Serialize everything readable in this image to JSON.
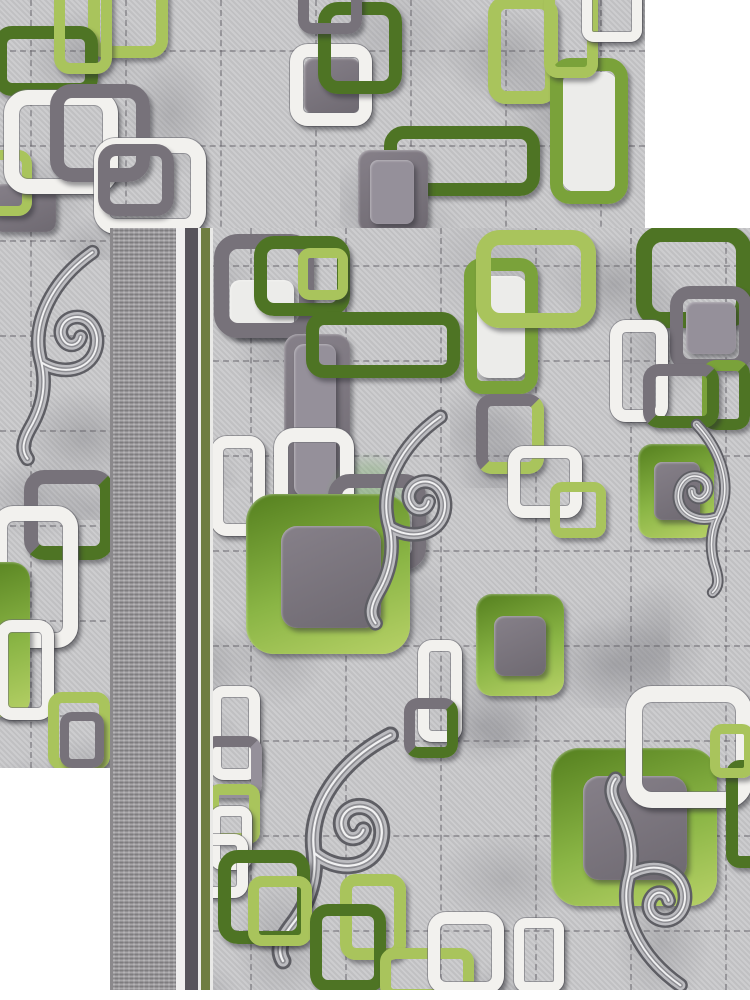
{
  "scene": {
    "kind": "photo-of-two-overlapping-carpet-samples",
    "background": "#ffffff",
    "pattern_style": "interlocked rounded-square chain links with damask scroll flourishes on marbled grey field with stitched grid"
  },
  "palette": {
    "white": "#f2f1ee",
    "white_fill": "#ececea",
    "dark_gray": "#77727a",
    "mid_gray": "#95909a",
    "dark_green": "#4e7424",
    "green": "#7aa23a",
    "lime": "#a9c45c",
    "field_base": "#cacacc",
    "green_fill": "linear-gradient(160deg,#55801f 0%,#8ab545 55%,#b7d167 100%)",
    "gray_fill": "linear-gradient(155deg,#868089 0%,#6e6971 100%)",
    "border_olive": "#6f7d41",
    "border_dark": "#57545b",
    "watermark_green": "rgba(113,170,96,0.55)"
  },
  "panels": [
    {
      "id": "back",
      "x": 0,
      "y": 0,
      "w": 645,
      "h": 768,
      "fx": 0,
      "grid": {
        "v": [
          30,
          125,
          220,
          315,
          410,
          505,
          600
        ],
        "h": [
          50,
          145,
          240,
          335,
          430,
          525,
          620,
          715
        ]
      }
    },
    {
      "id": "front",
      "x": 110,
      "y": 228,
      "w": 640,
      "h": 762,
      "fx": 103,
      "grid": {
        "v": [
          37,
          132,
          227,
          322,
          417,
          512
        ],
        "h": [
          37,
          132,
          227,
          322,
          417,
          512,
          607,
          702
        ]
      },
      "stripes": [
        {
          "x": 0,
          "w": 3,
          "c": "#8b898c"
        },
        {
          "x": 3,
          "w": 63,
          "texture": true
        },
        {
          "x": 66,
          "w": 9,
          "c": "#f0efef"
        },
        {
          "x": 75,
          "w": 13,
          "c": "#57545b"
        },
        {
          "x": 88,
          "w": 3,
          "c": "#ededec"
        },
        {
          "x": 91,
          "w": 9,
          "c": "#6f7d41"
        },
        {
          "x": 100,
          "w": 3,
          "c": "#e9e9e7"
        }
      ]
    }
  ],
  "motifs": [
    {
      "p": "back",
      "t": "ring",
      "x": 88,
      "y": -20,
      "w": 80,
      "h": 78,
      "r": 18,
      "b": 12,
      "c": "lime"
    },
    {
      "p": "back",
      "t": "ring",
      "x": -6,
      "y": 26,
      "w": 104,
      "h": 70,
      "r": 18,
      "b": 13,
      "c": "dark_green"
    },
    {
      "p": "back",
      "t": "ring",
      "x": 54,
      "y": -24,
      "w": 58,
      "h": 98,
      "r": 16,
      "b": 11,
      "c": "lime"
    },
    {
      "p": "back",
      "t": "fill",
      "x": -8,
      "y": 184,
      "w": 64,
      "h": 48,
      "r": 10,
      "c": "gray_fill"
    },
    {
      "p": "back",
      "t": "ring",
      "x": -14,
      "y": 150,
      "w": 46,
      "h": 66,
      "r": 14,
      "b": 10,
      "c": "lime"
    },
    {
      "p": "back",
      "t": "ring",
      "x": 4,
      "y": 90,
      "w": 114,
      "h": 104,
      "r": 24,
      "b": 15,
      "c": "white"
    },
    {
      "p": "back",
      "t": "ring",
      "x": 50,
      "y": 84,
      "w": 100,
      "h": 98,
      "r": 22,
      "b": 14,
      "c": "dark_gray"
    },
    {
      "p": "back",
      "t": "ring",
      "x": 94,
      "y": 138,
      "w": 112,
      "h": 96,
      "r": 22,
      "b": 15,
      "c": "white"
    },
    {
      "p": "back",
      "t": "ring",
      "x": 98,
      "y": 144,
      "w": 76,
      "h": 72,
      "r": 18,
      "b": 12,
      "c": "dark_gray"
    },
    {
      "p": "back",
      "t": "fill",
      "x": 304,
      "y": 58,
      "w": 56,
      "h": 56,
      "r": 10,
      "c": "gray_fill"
    },
    {
      "p": "back",
      "t": "ring",
      "x": 290,
      "y": 44,
      "w": 82,
      "h": 82,
      "r": 18,
      "b": 13,
      "c": "white"
    },
    {
      "p": "back",
      "t": "ring",
      "x": 318,
      "y": 2,
      "w": 84,
      "h": 92,
      "r": 20,
      "b": 13,
      "c": "dark_green"
    },
    {
      "p": "back",
      "t": "ring",
      "x": 298,
      "y": -18,
      "w": 64,
      "h": 52,
      "r": 14,
      "b": 11,
      "c": "dark_gray"
    },
    {
      "p": "back",
      "t": "ring",
      "x": 384,
      "y": 126,
      "w": 156,
      "h": 70,
      "r": 20,
      "b": 13,
      "c": "dark_green"
    },
    {
      "p": "back",
      "t": "fill",
      "x": 358,
      "y": 150,
      "w": 70,
      "h": 82,
      "r": 12,
      "c": "gray_fill"
    },
    {
      "p": "back",
      "t": "fill",
      "x": 370,
      "y": 160,
      "w": 44,
      "h": 64,
      "r": 8,
      "c": "mid_gray"
    },
    {
      "p": "back",
      "t": "ring",
      "x": 488,
      "y": -4,
      "w": 70,
      "h": 108,
      "r": 18,
      "b": 13,
      "c": "lime"
    },
    {
      "p": "back",
      "t": "fill",
      "x": 562,
      "y": 72,
      "w": 56,
      "h": 120,
      "r": 14,
      "c": "white_fill"
    },
    {
      "p": "back",
      "t": "ring",
      "x": 550,
      "y": 58,
      "w": 78,
      "h": 146,
      "r": 20,
      "b": 13,
      "c": "green"
    },
    {
      "p": "back",
      "t": "ring",
      "x": 544,
      "y": -14,
      "w": 54,
      "h": 92,
      "r": 14,
      "b": 11,
      "c": "lime"
    },
    {
      "p": "back",
      "t": "ring",
      "x": 582,
      "y": -16,
      "w": 60,
      "h": 58,
      "r": 12,
      "b": 10,
      "c": "white"
    },
    {
      "p": "back",
      "t": "flourish",
      "x": 2,
      "y": 232,
      "w": 118,
      "h": 245,
      "rot": 0,
      "flip": false
    },
    {
      "p": "back",
      "t": "ring",
      "x": 24,
      "y": 470,
      "w": 90,
      "h": 90,
      "r": 20,
      "b": 14,
      "c": "dark_gray",
      "c2": "dark_green"
    },
    {
      "p": "back",
      "t": "ring",
      "x": -8,
      "y": 506,
      "w": 86,
      "h": 142,
      "r": 22,
      "b": 15,
      "c": "white"
    },
    {
      "p": "back",
      "t": "fill",
      "x": -34,
      "y": 562,
      "w": 64,
      "h": 155,
      "r": 18,
      "c": "green_fill"
    },
    {
      "p": "back",
      "t": "ring",
      "x": -4,
      "y": 620,
      "w": 58,
      "h": 100,
      "r": 16,
      "b": 12,
      "c": "white"
    },
    {
      "p": "back",
      "t": "ring",
      "x": 48,
      "y": 692,
      "w": 62,
      "h": 78,
      "r": 14,
      "b": 11,
      "c": "lime"
    },
    {
      "p": "back",
      "t": "ring",
      "x": 60,
      "y": 712,
      "w": 44,
      "h": 56,
      "r": 12,
      "b": 9,
      "c": "dark_gray"
    },
    {
      "p": "front",
      "t": "fill",
      "x": 230,
      "y": 280,
      "w": 64,
      "h": 58,
      "r": 10,
      "c": "white_fill"
    },
    {
      "p": "front",
      "t": "ring",
      "x": 214,
      "y": 234,
      "w": 100,
      "h": 104,
      "r": 24,
      "b": 15,
      "c": "dark_gray"
    },
    {
      "p": "front",
      "t": "ring",
      "x": 254,
      "y": 236,
      "w": 96,
      "h": 80,
      "r": 20,
      "b": 13,
      "c": "dark_green"
    },
    {
      "p": "front",
      "t": "ring",
      "x": 298,
      "y": 248,
      "w": 50,
      "h": 52,
      "r": 12,
      "b": 10,
      "c": "lime"
    },
    {
      "p": "front",
      "t": "fill",
      "x": 284,
      "y": 334,
      "w": 66,
      "h": 180,
      "r": 14,
      "c": "gray_fill"
    },
    {
      "p": "front",
      "t": "fill",
      "x": 294,
      "y": 344,
      "w": 42,
      "h": 152,
      "r": 10,
      "c": "mid_gray"
    },
    {
      "p": "front",
      "t": "ring",
      "x": 306,
      "y": 312,
      "w": 154,
      "h": 66,
      "r": 18,
      "b": 13,
      "c": "dark_green"
    },
    {
      "p": "front",
      "t": "fill",
      "x": 477,
      "y": 276,
      "w": 50,
      "h": 102,
      "r": 12,
      "c": "white_fill"
    },
    {
      "p": "front",
      "t": "ring",
      "x": 464,
      "y": 258,
      "w": 74,
      "h": 136,
      "r": 18,
      "b": 13,
      "c": "green"
    },
    {
      "p": "front",
      "t": "ring",
      "x": 476,
      "y": 230,
      "w": 120,
      "h": 98,
      "r": 24,
      "b": 15,
      "c": "lime"
    },
    {
      "p": "front",
      "t": "ring",
      "x": 636,
      "y": 226,
      "w": 116,
      "h": 102,
      "r": 26,
      "b": 16,
      "c": "dark_green"
    },
    {
      "p": "front",
      "t": "fill",
      "x": 686,
      "y": 302,
      "w": 50,
      "h": 52,
      "r": 8,
      "c": "mid_gray"
    },
    {
      "p": "front",
      "t": "ring",
      "x": 670,
      "y": 286,
      "w": 82,
      "h": 86,
      "r": 20,
      "b": 13,
      "c": "dark_gray"
    },
    {
      "p": "front",
      "t": "ring",
      "x": 610,
      "y": 320,
      "w": 58,
      "h": 102,
      "r": 16,
      "b": 12,
      "c": "white"
    },
    {
      "p": "front",
      "t": "ring",
      "x": 702,
      "y": 360,
      "w": 48,
      "h": 70,
      "r": 14,
      "b": 11,
      "c": "green",
      "c2": "dark_green"
    },
    {
      "p": "front",
      "t": "ring",
      "x": 643,
      "y": 364,
      "w": 76,
      "h": 64,
      "r": 16,
      "b": 12,
      "c": "dark_gray",
      "c2": "dark_green"
    },
    {
      "p": "front",
      "t": "fill",
      "x": 638,
      "y": 444,
      "w": 76,
      "h": 94,
      "r": 14,
      "c": "green_fill"
    },
    {
      "p": "front",
      "t": "fill",
      "x": 654,
      "y": 462,
      "w": 46,
      "h": 58,
      "r": 8,
      "c": "gray_fill"
    },
    {
      "p": "front",
      "t": "watermark",
      "x": 310,
      "y": 436,
      "w": 118,
      "h": 138
    },
    {
      "p": "front",
      "t": "ring",
      "x": 274,
      "y": 428,
      "w": 80,
      "h": 104,
      "r": 20,
      "b": 14,
      "c": "white"
    },
    {
      "p": "front",
      "t": "ring",
      "x": 211,
      "y": 436,
      "w": 54,
      "h": 100,
      "r": 16,
      "b": 12,
      "c": "white"
    },
    {
      "p": "front",
      "t": "ring",
      "x": 328,
      "y": 474,
      "w": 98,
      "h": 96,
      "r": 22,
      "b": 14,
      "c": "dark_gray"
    },
    {
      "p": "front",
      "t": "fill",
      "x": 246,
      "y": 494,
      "w": 164,
      "h": 160,
      "r": 28,
      "c": "green_fill"
    },
    {
      "p": "front",
      "t": "fill",
      "x": 281,
      "y": 526,
      "w": 100,
      "h": 102,
      "r": 16,
      "c": "gray_fill"
    },
    {
      "p": "front",
      "t": "flourish",
      "x": 350,
      "y": 404,
      "w": 118,
      "h": 230,
      "rot": 0,
      "flip": false
    },
    {
      "p": "front",
      "t": "ring",
      "x": 476,
      "y": 394,
      "w": 68,
      "h": 80,
      "r": 16,
      "b": 12,
      "c": "dark_gray",
      "c2": "lime"
    },
    {
      "p": "front",
      "t": "ring",
      "x": 508,
      "y": 446,
      "w": 74,
      "h": 72,
      "r": 16,
      "b": 12,
      "c": "white"
    },
    {
      "p": "front",
      "t": "ring",
      "x": 550,
      "y": 482,
      "w": 56,
      "h": 56,
      "r": 12,
      "b": 10,
      "c": "lime"
    },
    {
      "p": "front",
      "t": "fill",
      "x": 476,
      "y": 594,
      "w": 88,
      "h": 102,
      "r": 16,
      "c": "green_fill"
    },
    {
      "p": "front",
      "t": "fill",
      "x": 494,
      "y": 616,
      "w": 52,
      "h": 60,
      "r": 10,
      "c": "gray_fill"
    },
    {
      "p": "front",
      "t": "flourish",
      "x": 658,
      "y": 420,
      "w": 92,
      "h": 175,
      "rot": 12,
      "flip": true
    },
    {
      "p": "front",
      "t": "ring",
      "x": 418,
      "y": 640,
      "w": 44,
      "h": 102,
      "r": 14,
      "b": 11,
      "c": "white"
    },
    {
      "p": "front",
      "t": "ring",
      "x": 404,
      "y": 698,
      "w": 54,
      "h": 60,
      "r": 14,
      "b": 11,
      "c": "dark_gray",
      "c2": "dark_green"
    },
    {
      "p": "front",
      "t": "ring",
      "x": 210,
      "y": 686,
      "w": 50,
      "h": 94,
      "r": 14,
      "b": 11,
      "c": "white"
    },
    {
      "p": "front",
      "t": "ring",
      "x": 202,
      "y": 736,
      "w": 60,
      "h": 62,
      "r": 14,
      "b": 11,
      "c": "dark_gray",
      "c2": "mid_gray"
    },
    {
      "p": "front",
      "t": "ring",
      "x": 208,
      "y": 784,
      "w": 52,
      "h": 60,
      "r": 12,
      "b": 11,
      "c": "lime"
    },
    {
      "p": "front",
      "t": "ring",
      "x": 210,
      "y": 806,
      "w": 42,
      "h": 64,
      "r": 12,
      "b": 10,
      "c": "white"
    },
    {
      "p": "front",
      "t": "fill",
      "x": 551,
      "y": 748,
      "w": 166,
      "h": 158,
      "r": 28,
      "c": "green_fill"
    },
    {
      "p": "front",
      "t": "fill",
      "x": 583,
      "y": 776,
      "w": 104,
      "h": 104,
      "r": 16,
      "c": "gray_fill"
    },
    {
      "p": "front",
      "t": "ring",
      "x": 626,
      "y": 686,
      "w": 126,
      "h": 122,
      "r": 26,
      "b": 16,
      "c": "white"
    },
    {
      "p": "front",
      "t": "flourish",
      "x": 590,
      "y": 772,
      "w": 118,
      "h": 222,
      "rot": 180,
      "flip": true
    },
    {
      "p": "front",
      "t": "flourish",
      "x": 258,
      "y": 722,
      "w": 160,
      "h": 250,
      "rot": 8,
      "flip": false
    },
    {
      "p": "front",
      "t": "ring",
      "x": 194,
      "y": 834,
      "w": 54,
      "h": 64,
      "r": 14,
      "b": 11,
      "c": "white"
    },
    {
      "p": "front",
      "t": "ring",
      "x": 218,
      "y": 850,
      "w": 92,
      "h": 94,
      "r": 20,
      "b": 13,
      "c": "dark_green"
    },
    {
      "p": "front",
      "t": "ring",
      "x": 248,
      "y": 876,
      "w": 64,
      "h": 70,
      "r": 14,
      "b": 11,
      "c": "lime"
    },
    {
      "p": "front",
      "t": "ring",
      "x": 340,
      "y": 874,
      "w": 66,
      "h": 86,
      "r": 16,
      "b": 12,
      "c": "lime"
    },
    {
      "p": "front",
      "t": "ring",
      "x": 310,
      "y": 904,
      "w": 76,
      "h": 88,
      "r": 18,
      "b": 12,
      "c": "dark_green"
    },
    {
      "p": "front",
      "t": "ring",
      "x": 380,
      "y": 948,
      "w": 94,
      "h": 52,
      "r": 14,
      "b": 11,
      "c": "lime"
    },
    {
      "p": "front",
      "t": "ring",
      "x": 428,
      "y": 912,
      "w": 76,
      "h": 82,
      "r": 18,
      "b": 12,
      "c": "white"
    },
    {
      "p": "front",
      "t": "ring",
      "x": 514,
      "y": 918,
      "w": 50,
      "h": 74,
      "r": 12,
      "b": 10,
      "c": "white"
    },
    {
      "p": "front",
      "t": "ring",
      "x": 726,
      "y": 760,
      "w": 42,
      "h": 108,
      "r": 14,
      "b": 12,
      "c": "dark_green"
    },
    {
      "p": "front",
      "t": "ring",
      "x": 710,
      "y": 724,
      "w": 44,
      "h": 54,
      "r": 12,
      "b": 10,
      "c": "lime"
    }
  ]
}
